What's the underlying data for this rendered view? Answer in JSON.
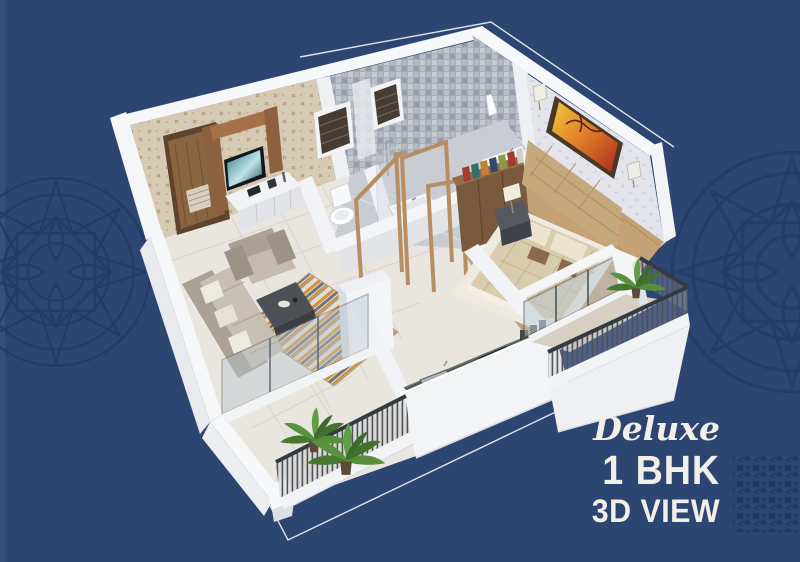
{
  "poster": {
    "title_script": "Deluxe",
    "title_main": "1 BHK",
    "title_sub": "3D VIEW",
    "colors": {
      "background": "#2d4571",
      "arabesque_pattern": "#233a66",
      "corner_ornament": "#1e3560",
      "text": "#f2efe8",
      "accent_line": "#ffffff",
      "wall_white": "#f4f5f7",
      "living_wallpaper": "#d8ccb8",
      "bathroom_tile": "#a8aeb8",
      "bedroom_wallpaper": "#e5e5ec",
      "wood_furniture": "#7a5a3e",
      "rug_orange": "#d2913f",
      "kitchen_counter": "#49564f",
      "railing": "#40464e",
      "plant_green": "#4f8040"
    }
  }
}
